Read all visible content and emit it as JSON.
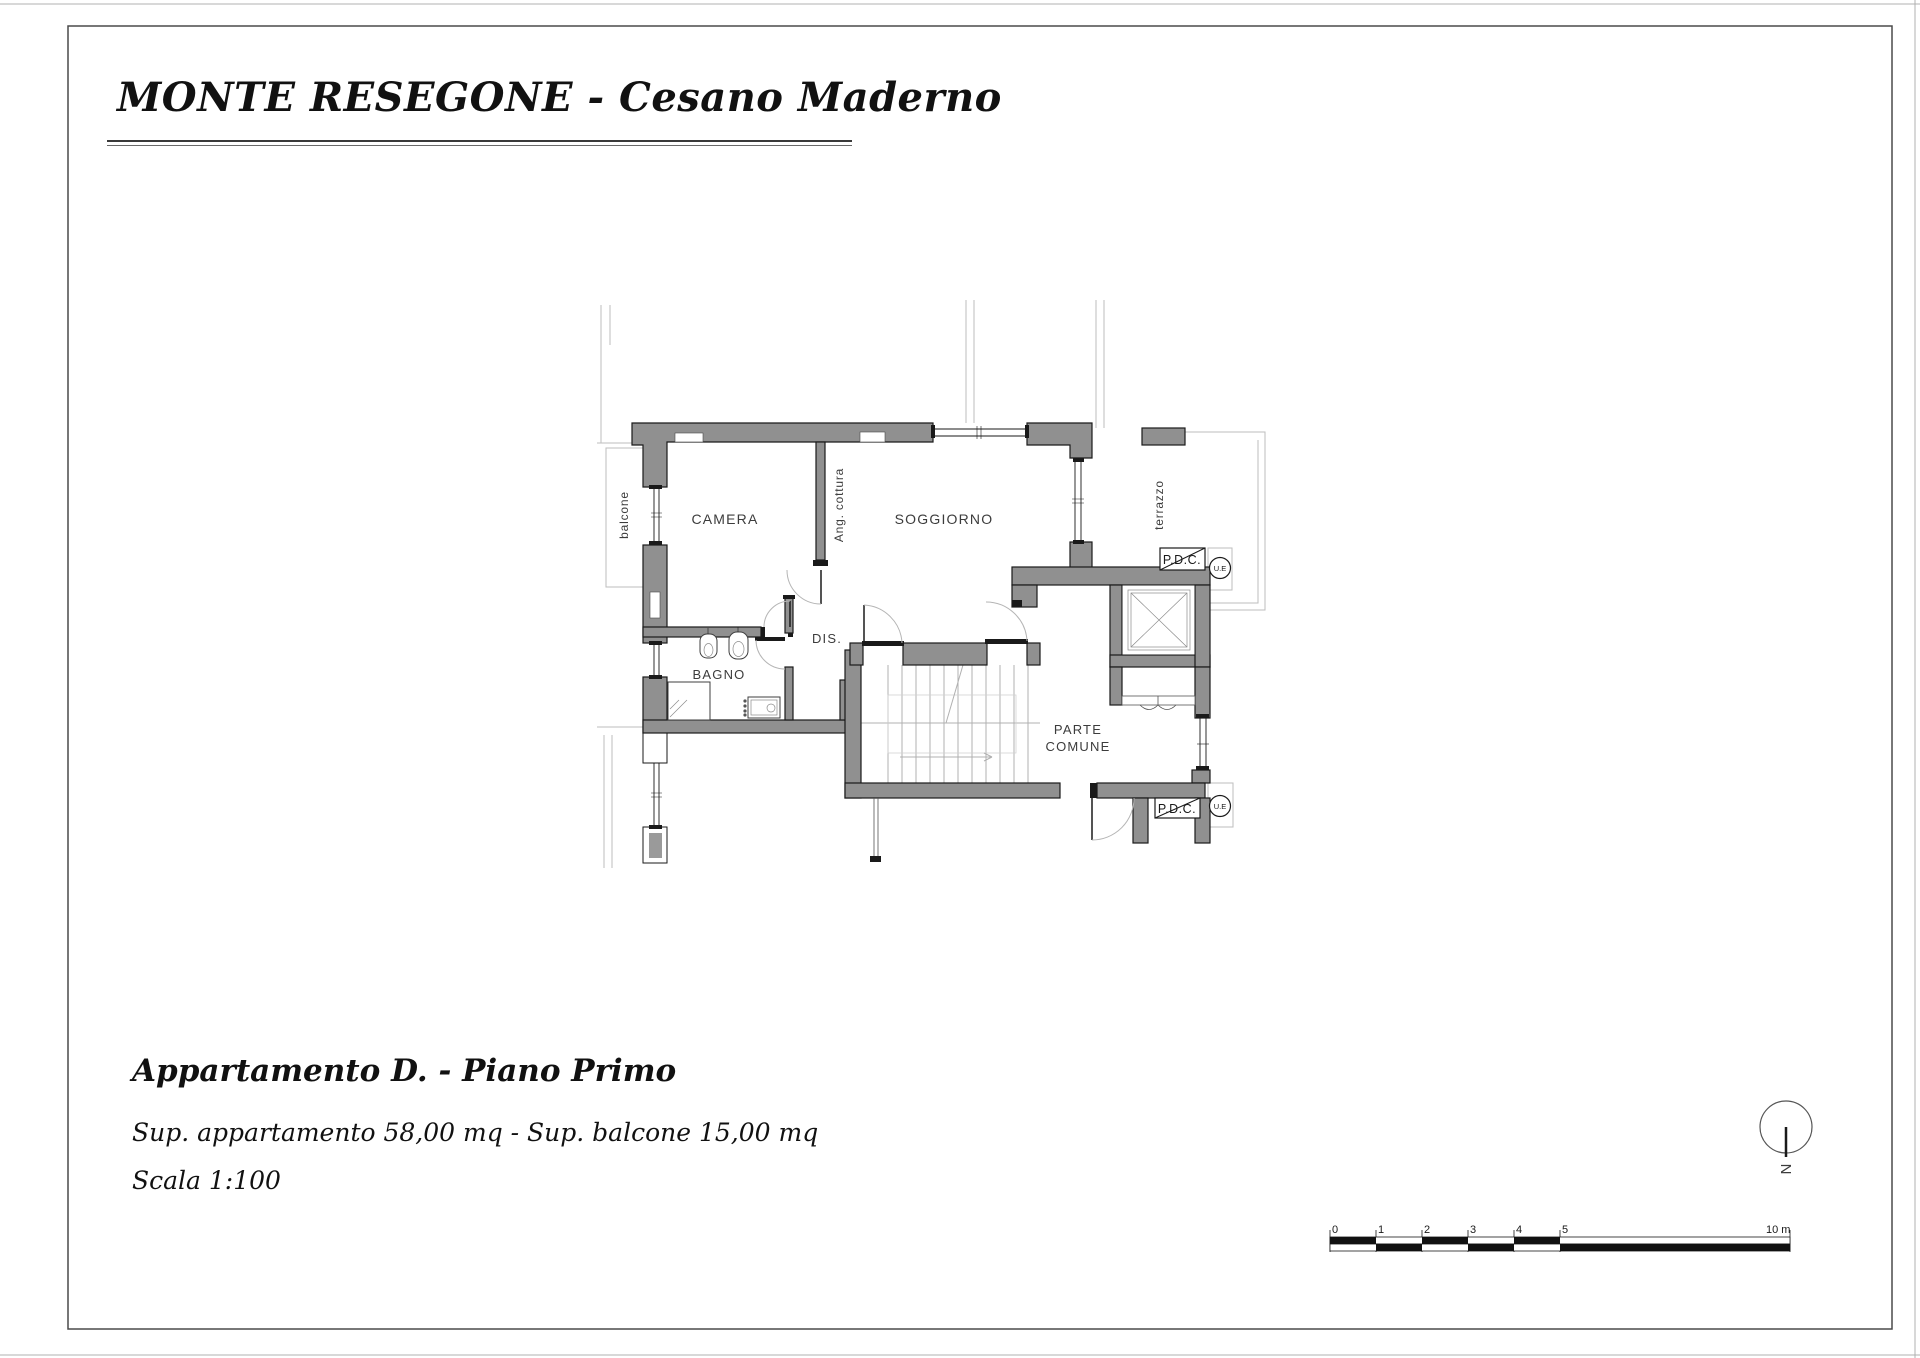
{
  "header": {
    "title": "MONTE RESEGONE - Cesano Maderno"
  },
  "footer": {
    "apartment": "Appartamento D. - Piano Primo",
    "surfaces": "Sup. appartamento 58,00 mq - Sup. balcone 15,00 mq",
    "scale": "Scala 1:100"
  },
  "plan": {
    "labels": {
      "camera": "CAMERA",
      "soggiorno": "SOGGIORNO",
      "dis": "DIS.",
      "bagno": "BAGNO",
      "parte_comune_1": "PARTE",
      "parte_comune_2": "COMUNE",
      "balcone": "balcone",
      "ang_cottura": "Ang. cottura",
      "terrazzo": "terrazzo",
      "pdc_top": "P.D.C.",
      "ue_top": "U.E",
      "pdc_bottom": "P.D.C.",
      "ue_bottom": "U.E"
    },
    "north_label": "N"
  },
  "scale_bar": {
    "ticks": [
      "0",
      "1",
      "2",
      "3",
      "4",
      "5"
    ],
    "end_label": "10 m"
  },
  "colors": {
    "wall_fill": "#909090",
    "outline": "#1a1a1a",
    "light_line": "#bdbdbd",
    "text": "#3c3c3c"
  }
}
